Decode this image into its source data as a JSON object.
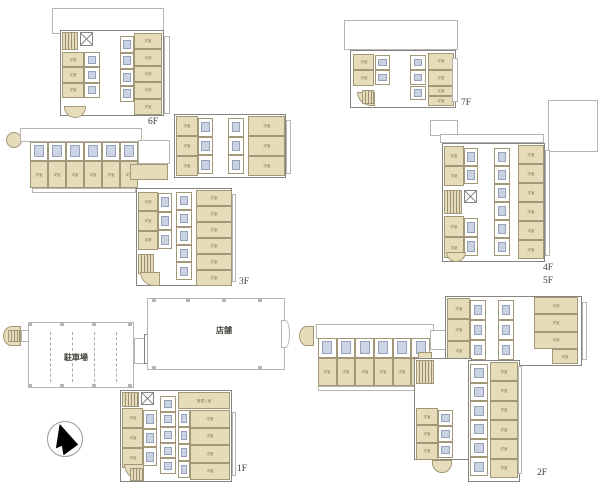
{
  "page": {
    "width": 600,
    "height": 486,
    "background": "#ffffff"
  },
  "colors": {
    "outline": "#b7b5b0",
    "wall": "#85847f",
    "roomFill": "#e7dcba",
    "roomB": "#a29878",
    "roomT": "#857753",
    "fixFill": "#c9d3e4",
    "fixB": "#97a2b8",
    "bedFill": "#ccd5e6",
    "stairL": "#9a8f72",
    "txt": "#44413a",
    "compass": "#000000"
  },
  "labels": {
    "room": "洋室",
    "manager_room": "管理人室",
    "store": "店舗",
    "parking": "駐車場",
    "floor1": "1F",
    "floor2": "2F",
    "floor3": "3F",
    "floor4": "4F",
    "floor5": "5F",
    "floor6": "6F",
    "floor7": "7F"
  },
  "plans": [
    {
      "id": "6f",
      "elements": [
        {
          "t": "out",
          "r": [
            52,
            8,
            112,
            26
          ]
        },
        {
          "t": "out",
          "r": [
            164,
            36,
            6,
            78
          ]
        },
        {
          "t": "wall",
          "r": [
            60,
            30,
            104,
            86
          ]
        },
        {
          "t": "stair",
          "r": [
            62,
            32,
            16,
            18
          ]
        },
        {
          "t": "elev",
          "r": [
            80,
            32,
            13,
            14
          ]
        },
        {
          "t": "roomCol",
          "r": [
            62,
            52,
            22,
            46
          ],
          "n": 3
        },
        {
          "t": "bathCol",
          "r": [
            84,
            52,
            16,
            46
          ],
          "n": 3
        },
        {
          "t": "bathCol",
          "r": [
            120,
            36,
            14,
            66
          ],
          "n": 4
        },
        {
          "t": "roomCol",
          "r": [
            134,
            33,
            28,
            82
          ],
          "n": 5
        },
        {
          "t": "balc",
          "r": [
            64,
            106,
            22,
            12
          ],
          "rad": "0 0 12px 12px"
        },
        {
          "t": "text",
          "r": [
            148,
            118
          ],
          "k": "floor6",
          "fs": 9.5
        }
      ]
    },
    {
      "id": "7f",
      "elements": [
        {
          "t": "out",
          "r": [
            344,
            20,
            114,
            30
          ]
        },
        {
          "t": "wall",
          "r": [
            350,
            50,
            106,
            58
          ]
        },
        {
          "t": "roomCol",
          "r": [
            353,
            54,
            21,
            32
          ],
          "n": 2
        },
        {
          "t": "bathCol",
          "r": [
            375,
            55,
            15,
            30
          ],
          "n": 2
        },
        {
          "t": "balc",
          "r": [
            357,
            92,
            18,
            14
          ],
          "rad": "0 0 0 14px"
        },
        {
          "t": "stair",
          "r": [
            362,
            90,
            12,
            14
          ]
        },
        {
          "t": "bathCol",
          "r": [
            410,
            55,
            16,
            30
          ],
          "n": 2
        },
        {
          "t": "roomCol",
          "r": [
            428,
            53,
            26,
            33
          ],
          "n": 2
        },
        {
          "t": "bathCol",
          "r": [
            410,
            86,
            16,
            14
          ],
          "n": 1
        },
        {
          "t": "roomCol",
          "r": [
            428,
            86,
            26,
            20
          ],
          "n": 2
        },
        {
          "t": "out",
          "r": [
            452,
            58,
            6,
            44
          ]
        },
        {
          "t": "text",
          "r": [
            461,
            99
          ],
          "k": "floor7",
          "fs": 9.5
        }
      ]
    },
    {
      "id": "3f",
      "elements": [
        {
          "t": "balc",
          "r": [
            6,
            132,
            16,
            16
          ],
          "rad": "50%"
        },
        {
          "t": "out",
          "r": [
            20,
            128,
            122,
            14
          ]
        },
        {
          "t": "rowH",
          "r": [
            30,
            142,
            108,
            46
          ],
          "n": 6
        },
        {
          "t": "out",
          "r": [
            32,
            188,
            104,
            5
          ]
        },
        {
          "t": "out",
          "r": [
            138,
            140,
            32,
            24
          ]
        },
        {
          "t": "room",
          "r": [
            130,
            164,
            38,
            16
          ]
        },
        {
          "t": "wall",
          "r": [
            174,
            114,
            112,
            64
          ]
        },
        {
          "t": "roomCol",
          "r": [
            176,
            116,
            22,
            60
          ],
          "n": 3
        },
        {
          "t": "bathCol",
          "r": [
            198,
            118,
            15,
            56
          ],
          "n": 3
        },
        {
          "t": "bathCol",
          "r": [
            228,
            118,
            16,
            56
          ],
          "n": 3
        },
        {
          "t": "roomCol",
          "r": [
            248,
            116,
            37,
            60
          ],
          "n": 3
        },
        {
          "t": "out",
          "r": [
            286,
            120,
            5,
            54
          ]
        },
        {
          "t": "wall",
          "r": [
            136,
            188,
            96,
            98
          ]
        },
        {
          "t": "roomCol",
          "r": [
            138,
            192,
            20,
            58
          ],
          "n": 3
        },
        {
          "t": "bathCol",
          "r": [
            158,
            193,
            14,
            56
          ],
          "n": 3
        },
        {
          "t": "stair",
          "r": [
            138,
            254,
            16,
            20
          ]
        },
        {
          "t": "balc",
          "r": [
            140,
            272,
            20,
            14
          ],
          "rad": "0 0 0 14px"
        },
        {
          "t": "bathCol",
          "r": [
            176,
            192,
            16,
            88
          ],
          "n": 5
        },
        {
          "t": "roomCol",
          "r": [
            196,
            190,
            36,
            96
          ],
          "n": 6
        },
        {
          "t": "out",
          "r": [
            232,
            194,
            4,
            88
          ]
        },
        {
          "t": "text",
          "r": [
            239,
            278
          ],
          "k": "floor3",
          "fs": 9.5
        }
      ]
    },
    {
      "id": "4f5f",
      "elements": [
        {
          "t": "out",
          "r": [
            548,
            100,
            50,
            52
          ]
        },
        {
          "t": "out",
          "r": [
            430,
            120,
            28,
            16
          ]
        },
        {
          "t": "out",
          "r": [
            440,
            134,
            104,
            9
          ]
        },
        {
          "t": "wall",
          "r": [
            442,
            143,
            103,
            119
          ]
        },
        {
          "t": "roomCol",
          "r": [
            444,
            146,
            20,
            40
          ],
          "n": 2
        },
        {
          "t": "bathCol",
          "r": [
            464,
            148,
            14,
            36
          ],
          "n": 2
        },
        {
          "t": "stair",
          "r": [
            444,
            190,
            18,
            24
          ]
        },
        {
          "t": "elev",
          "r": [
            464,
            190,
            13,
            13
          ]
        },
        {
          "t": "roomCol",
          "r": [
            444,
            216,
            20,
            42
          ],
          "n": 2
        },
        {
          "t": "bathCol",
          "r": [
            464,
            218,
            14,
            38
          ],
          "n": 2
        },
        {
          "t": "bathCol",
          "r": [
            494,
            148,
            16,
            108
          ],
          "n": 6
        },
        {
          "t": "roomCol",
          "r": [
            518,
            145,
            26,
            114
          ],
          "n": 6
        },
        {
          "t": "balc",
          "r": [
            446,
            252,
            20,
            10
          ],
          "rad": "0 0 12px 12px"
        },
        {
          "t": "out",
          "r": [
            545,
            150,
            5,
            106
          ]
        },
        {
          "t": "text",
          "r": [
            543,
            264
          ],
          "k": "floor4",
          "fs": 9.5
        },
        {
          "t": "text",
          "r": [
            543,
            277
          ],
          "k": "floor5",
          "fs": 9.5
        }
      ]
    },
    {
      "id": "1f",
      "elements": [
        {
          "t": "balc",
          "r": [
            3,
            326,
            18,
            20
          ],
          "rad": "50% 0 0 50%"
        },
        {
          "t": "stair",
          "r": [
            8,
            330,
            12,
            12
          ]
        },
        {
          "t": "out",
          "r": [
            21,
            330,
            14,
            12
          ]
        },
        {
          "t": "out",
          "r": [
            28,
            322,
            106,
            66
          ]
        },
        {
          "t": "colsq",
          "r": [
            28,
            322,
            4,
            4
          ]
        },
        {
          "t": "colsq",
          "r": [
            60,
            322,
            4,
            4
          ]
        },
        {
          "t": "colsq",
          "r": [
            92,
            322,
            4,
            4
          ]
        },
        {
          "t": "colsq",
          "r": [
            128,
            322,
            4,
            4
          ]
        },
        {
          "t": "colsq",
          "r": [
            28,
            384,
            4,
            4
          ]
        },
        {
          "t": "colsq",
          "r": [
            60,
            384,
            4,
            4
          ]
        },
        {
          "t": "colsq",
          "r": [
            92,
            384,
            4,
            4
          ]
        },
        {
          "t": "colsq",
          "r": [
            128,
            384,
            4,
            4
          ]
        },
        {
          "t": "dashv",
          "r": [
            50,
            332,
            1,
            50
          ]
        },
        {
          "t": "dashv",
          "r": [
            72,
            332,
            1,
            50
          ]
        },
        {
          "t": "dashv",
          "r": [
            94,
            332,
            1,
            50
          ]
        },
        {
          "t": "dashv",
          "r": [
            116,
            332,
            1,
            50
          ]
        },
        {
          "t": "text",
          "r": [
            64,
            354
          ],
          "k": "parking",
          "fs": 8,
          "b": true
        },
        {
          "t": "out",
          "r": [
            134,
            338,
            14,
            26
          ]
        },
        {
          "t": "wall",
          "r": [
            144,
            334,
            36,
            30
          ]
        },
        {
          "t": "out",
          "r": [
            147,
            298,
            138,
            72
          ]
        },
        {
          "t": "colsq",
          "r": [
            152,
            298,
            4,
            4
          ]
        },
        {
          "t": "colsq",
          "r": [
            186,
            298,
            4,
            4
          ]
        },
        {
          "t": "colsq",
          "r": [
            222,
            298,
            4,
            4
          ]
        },
        {
          "t": "colsq",
          "r": [
            258,
            298,
            4,
            4
          ]
        },
        {
          "t": "colsq",
          "r": [
            152,
            366,
            4,
            4
          ]
        },
        {
          "t": "colsq",
          "r": [
            258,
            366,
            4,
            4
          ]
        },
        {
          "t": "out",
          "r": [
            281,
            320,
            9,
            28
          ],
          "rad": "0 50% 50% 0"
        },
        {
          "t": "text",
          "r": [
            216,
            327
          ],
          "k": "store",
          "fs": 8,
          "b": true
        },
        {
          "t": "wall",
          "r": [
            120,
            390,
            112,
            92
          ]
        },
        {
          "t": "stair",
          "r": [
            122,
            392,
            17,
            15
          ]
        },
        {
          "t": "elev",
          "r": [
            141,
            392,
            13,
            13
          ]
        },
        {
          "t": "roomCol",
          "r": [
            122,
            408,
            21,
            60
          ],
          "n": 3
        },
        {
          "t": "bathCol",
          "r": [
            143,
            410,
            14,
            56
          ],
          "n": 3
        },
        {
          "t": "bathCol",
          "r": [
            160,
            396,
            16,
            78
          ],
          "n": 5
        },
        {
          "t": "room",
          "r": [
            178,
            392,
            52,
            17
          ],
          "k": "manager_room"
        },
        {
          "t": "bathCol",
          "r": [
            178,
            410,
            12,
            68
          ],
          "n": 4
        },
        {
          "t": "roomCol",
          "r": [
            190,
            410,
            40,
            70
          ],
          "n": 4
        },
        {
          "t": "balc",
          "r": [
            124,
            464,
            20,
            16
          ],
          "rad": "0 0 0 16px"
        },
        {
          "t": "stair",
          "r": [
            130,
            468,
            14,
            13
          ]
        },
        {
          "t": "out",
          "r": [
            232,
            412,
            4,
            64
          ]
        },
        {
          "t": "text",
          "r": [
            237,
            465
          ],
          "k": "floor1",
          "fs": 9.5
        }
      ]
    },
    {
      "id": "2f",
      "elements": [
        {
          "t": "balc",
          "r": [
            299,
            326,
            15,
            20
          ],
          "rad": "50% 0 0 50%"
        },
        {
          "t": "out",
          "r": [
            316,
            324,
            118,
            15
          ]
        },
        {
          "t": "rowH",
          "r": [
            318,
            338,
            112,
            48
          ],
          "n": 6
        },
        {
          "t": "out",
          "r": [
            318,
            386,
            110,
            5
          ]
        },
        {
          "t": "room",
          "r": [
            418,
            352,
            14,
            30
          ]
        },
        {
          "t": "out",
          "r": [
            430,
            330,
            34,
            20
          ]
        },
        {
          "t": "wall",
          "r": [
            445,
            296,
            137,
            70
          ]
        },
        {
          "t": "roomCol",
          "r": [
            447,
            298,
            23,
            64
          ],
          "n": 3
        },
        {
          "t": "bathCol",
          "r": [
            470,
            300,
            16,
            60
          ],
          "n": 3
        },
        {
          "t": "bathCol",
          "r": [
            498,
            300,
            16,
            60
          ],
          "n": 3
        },
        {
          "t": "roomCol",
          "r": [
            534,
            297,
            44,
            52
          ],
          "n": 3
        },
        {
          "t": "room",
          "r": [
            552,
            349,
            26,
            15
          ],
          "k": "room"
        },
        {
          "t": "out",
          "r": [
            582,
            302,
            5,
            58
          ]
        },
        {
          "t": "wall",
          "r": [
            414,
            358,
            58,
            102
          ]
        },
        {
          "t": "wall",
          "r": [
            468,
            360,
            52,
            122
          ]
        },
        {
          "t": "stair",
          "r": [
            416,
            360,
            18,
            24
          ]
        },
        {
          "t": "roomCol",
          "r": [
            416,
            408,
            22,
            52
          ],
          "n": 3
        },
        {
          "t": "bathCol",
          "r": [
            438,
            410,
            15,
            48
          ],
          "n": 3
        },
        {
          "t": "balc",
          "r": [
            432,
            460,
            20,
            13
          ],
          "rad": "0 0 14px 14px"
        },
        {
          "t": "bathCol",
          "r": [
            470,
            364,
            18,
            112
          ],
          "n": 6
        },
        {
          "t": "roomCol",
          "r": [
            490,
            362,
            28,
            116
          ],
          "n": 6
        },
        {
          "t": "out",
          "r": [
            518,
            366,
            4,
            108
          ]
        },
        {
          "t": "text",
          "r": [
            537,
            469
          ],
          "k": "floor2",
          "fs": 9.5
        }
      ]
    }
  ],
  "compass": {
    "x": 47,
    "y": 421,
    "size": 34
  }
}
